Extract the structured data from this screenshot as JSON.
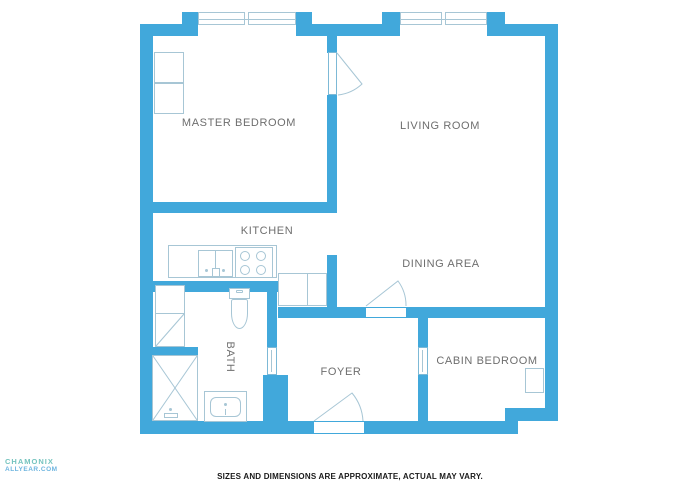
{
  "plan": {
    "rooms": {
      "master_bedroom": "MASTER BEDROOM",
      "living_room": "LIVING ROOM",
      "kitchen": "KITCHEN",
      "dining_area": "DINING AREA",
      "bath": "BATH",
      "foyer": "FOYER",
      "cabin_bedroom": "CABIN BEDROOM"
    },
    "fixtures": [
      "master-closet",
      "kitchen-counter",
      "kitchen-sink",
      "stove",
      "lower-cabinet",
      "bath-closet",
      "toilet",
      "vanity-sink",
      "shower",
      "cabin-closet",
      "bay-window",
      "door-swing"
    ]
  },
  "footer": {
    "disclaimer": "SIZES AND DIMENSIONS ARE APPROXIMATE, ACTUAL MAY VARY."
  },
  "watermark": {
    "line1": "CHAMONIX",
    "line2": "ALLYEAR.COM"
  },
  "colors": {
    "wall": "#41a8db",
    "fixture": "#a7c6d5",
    "opening": "#7db9d6",
    "label": "#6e6e6e",
    "footer_text": "#1a1a1a",
    "watermark_teal": "#52b5ae",
    "watermark_blue": "#4aa3d8"
  }
}
